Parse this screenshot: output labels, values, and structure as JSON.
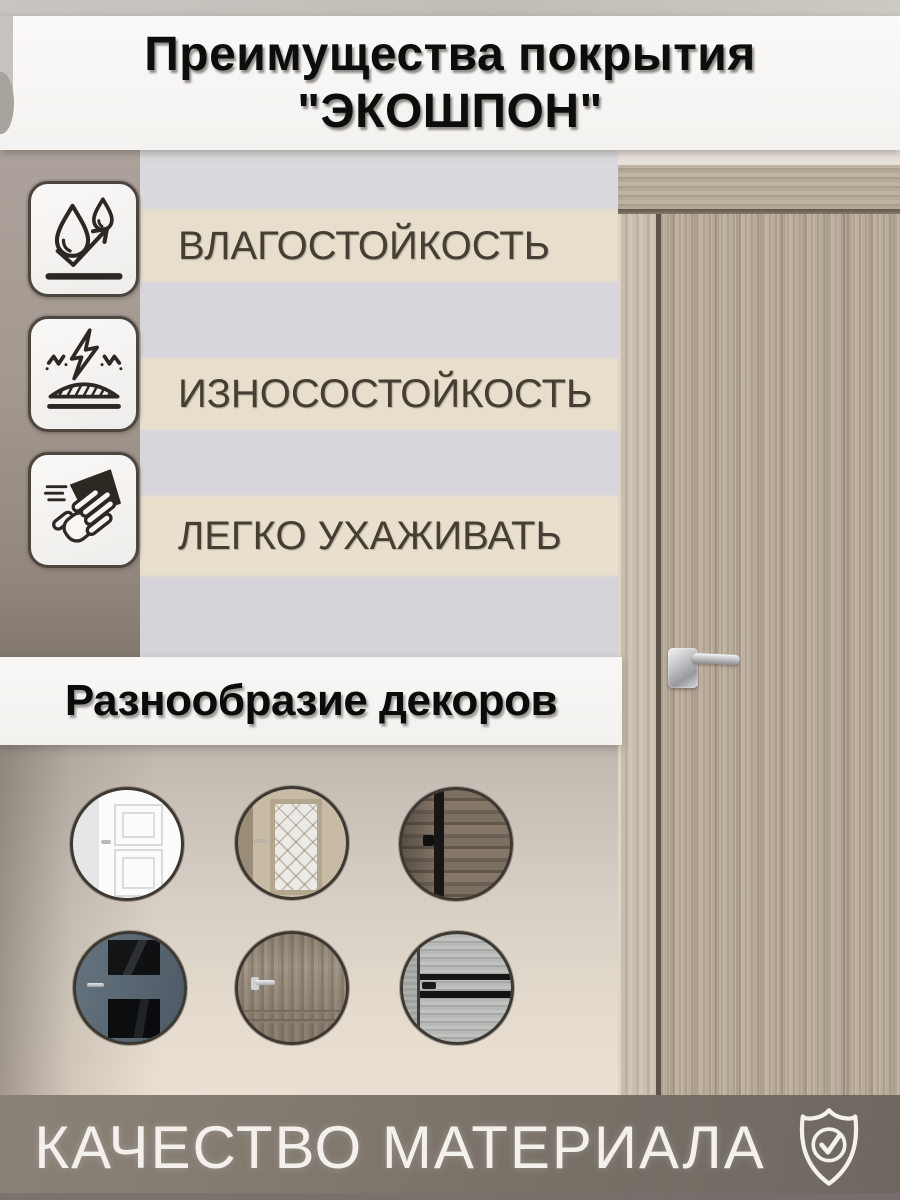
{
  "title": {
    "line1": "Преимущества покрытия",
    "line2": "\"ЭКОШПОН\""
  },
  "features": [
    {
      "label": "ВЛАГОСТОЙКОСТЬ",
      "icon": "water-drops-arrow-icon"
    },
    {
      "label": "ИЗНОСОСТОЙКОСТЬ",
      "icon": "impact-resistance-icon"
    },
    {
      "label": "ЛЕГКО УХАЖИВАТЬ",
      "icon": "wiping-hand-icon"
    }
  ],
  "decor_section": {
    "heading": "Разнообразие декоров",
    "items": [
      {
        "icon": "white-panel-door-photo"
      },
      {
        "icon": "glass-lattice-door-photo"
      },
      {
        "icon": "dark-rustic-wood-photo"
      },
      {
        "icon": "blue-door-dark-glass-photo"
      },
      {
        "icon": "taupe-wood-door-photo"
      },
      {
        "icon": "gray-wood-black-stripes-photo"
      }
    ]
  },
  "footer": {
    "label": "КАЧЕСТВО МАТЕРИАЛА",
    "icon": "shield-check-icon"
  },
  "colors": {
    "banner_bg": "#f7f6f3",
    "stripe_beige": "#e7dfcc",
    "stripe_gray": "#d8d6dc",
    "wall_taupe": "#a29890",
    "door_wood": "#b2a695",
    "footer_band": "#7c746a",
    "icon_ink": "#2d2823",
    "label_ink": "#463d33",
    "title_ink": "#0d0d0d",
    "footer_ink": "#f4f1ec"
  }
}
